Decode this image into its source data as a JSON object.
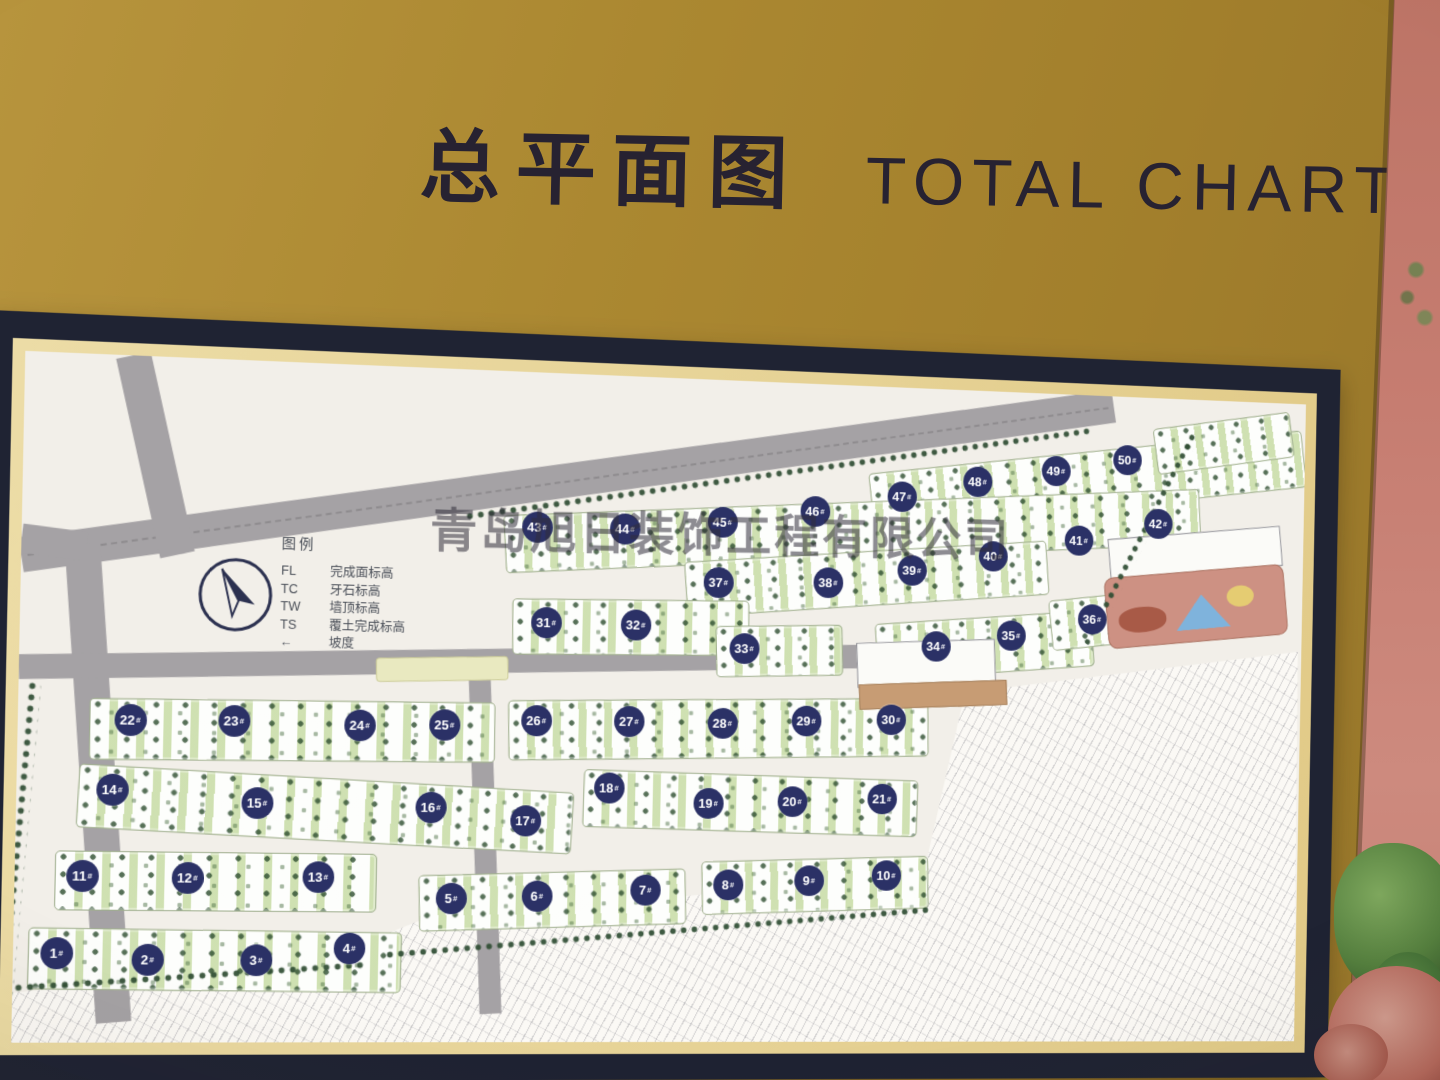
{
  "sign": {
    "title_zh": "总平面图",
    "title_en": "TOTAL CHART",
    "watermark": "青岛旭日装饰工程有限公司"
  },
  "legend": {
    "heading": "图例",
    "items": [
      {
        "code": "FL",
        "label": "完成面标高"
      },
      {
        "code": "TC",
        "label": "牙石标高"
      },
      {
        "code": "TW",
        "label": "墙顶标高"
      },
      {
        "code": "TS",
        "label": "覆土完成标高"
      },
      {
        "code": "←",
        "label": "坡度"
      }
    ]
  },
  "map": {
    "badges": [
      {
        "label": "1#",
        "x": 41,
        "y": 581
      },
      {
        "label": "2#",
        "x": 128,
        "y": 587
      },
      {
        "label": "3#",
        "x": 233,
        "y": 587
      },
      {
        "label": "4#",
        "x": 324,
        "y": 575
      },
      {
        "label": "5#",
        "x": 424,
        "y": 525
      },
      {
        "label": "6#",
        "x": 510,
        "y": 522
      },
      {
        "label": "7#",
        "x": 620,
        "y": 515
      },
      {
        "label": "8#",
        "x": 705,
        "y": 509
      },
      {
        "label": "9#",
        "x": 789,
        "y": 504
      },
      {
        "label": "10#",
        "x": 870,
        "y": 498
      },
      {
        "label": "11#",
        "x": 64,
        "y": 506
      },
      {
        "label": "12#",
        "x": 165,
        "y": 507
      },
      {
        "label": "13#",
        "x": 292,
        "y": 505
      },
      {
        "label": "14#",
        "x": 91,
        "y": 422
      },
      {
        "label": "15#",
        "x": 231,
        "y": 433
      },
      {
        "label": "16#",
        "x": 402,
        "y": 435
      },
      {
        "label": "17#",
        "x": 497,
        "y": 447
      },
      {
        "label": "18#",
        "x": 581,
        "y": 413
      },
      {
        "label": "19#",
        "x": 683,
        "y": 427
      },
      {
        "label": "20#",
        "x": 770,
        "y": 424
      },
      {
        "label": "21#",
        "x": 864,
        "y": 420
      },
      {
        "label": "22#",
        "x": 107,
        "y": 354
      },
      {
        "label": "23#",
        "x": 207,
        "y": 353
      },
      {
        "label": "24#",
        "x": 330,
        "y": 355
      },
      {
        "label": "25#",
        "x": 414,
        "y": 353
      },
      {
        "label": "26#",
        "x": 506,
        "y": 347
      },
      {
        "label": "27#",
        "x": 600,
        "y": 346
      },
      {
        "label": "28#",
        "x": 696,
        "y": 346
      },
      {
        "label": "29#",
        "x": 783,
        "y": 342
      },
      {
        "label": "30#",
        "x": 872,
        "y": 339
      },
      {
        "label": "31#",
        "x": 514,
        "y": 249
      },
      {
        "label": "32#",
        "x": 605,
        "y": 249
      },
      {
        "label": "33#",
        "x": 717,
        "y": 270
      },
      {
        "label": "34#",
        "x": 918,
        "y": 263
      },
      {
        "label": "35#",
        "x": 998,
        "y": 250
      },
      {
        "label": "36#",
        "x": 1085,
        "y": 231
      },
      {
        "label": "37#",
        "x": 689,
        "y": 204
      },
      {
        "label": "38#",
        "x": 803,
        "y": 201
      },
      {
        "label": "39#",
        "x": 891,
        "y": 186
      },
      {
        "label": "40#",
        "x": 977,
        "y": 169
      },
      {
        "label": "41#",
        "x": 1069,
        "y": 150
      },
      {
        "label": "42#",
        "x": 1155,
        "y": 130
      },
      {
        "label": "43#",
        "x": 503,
        "y": 154
      },
      {
        "label": "44#",
        "x": 592,
        "y": 153
      },
      {
        "label": "45#",
        "x": 692,
        "y": 143
      },
      {
        "label": "46#",
        "x": 788,
        "y": 129
      },
      {
        "label": "47#",
        "x": 879,
        "y": 111
      },
      {
        "label": "48#",
        "x": 959,
        "y": 93
      },
      {
        "label": "49#",
        "x": 1043,
        "y": 79
      },
      {
        "label": "50#",
        "x": 1120,
        "y": 65
      }
    ]
  },
  "colors": {
    "board_gold": "#ab8831",
    "frame_navy": "#1f2333",
    "trim_cream": "#e2cd8f",
    "map_bg": "#f2efe9",
    "road_gray": "#a5a2a5",
    "block_green": "#dce8c2",
    "tree_green": "#2f4d33",
    "badge_navy": "#2b3166",
    "wall_salmon": "#c67d71"
  }
}
